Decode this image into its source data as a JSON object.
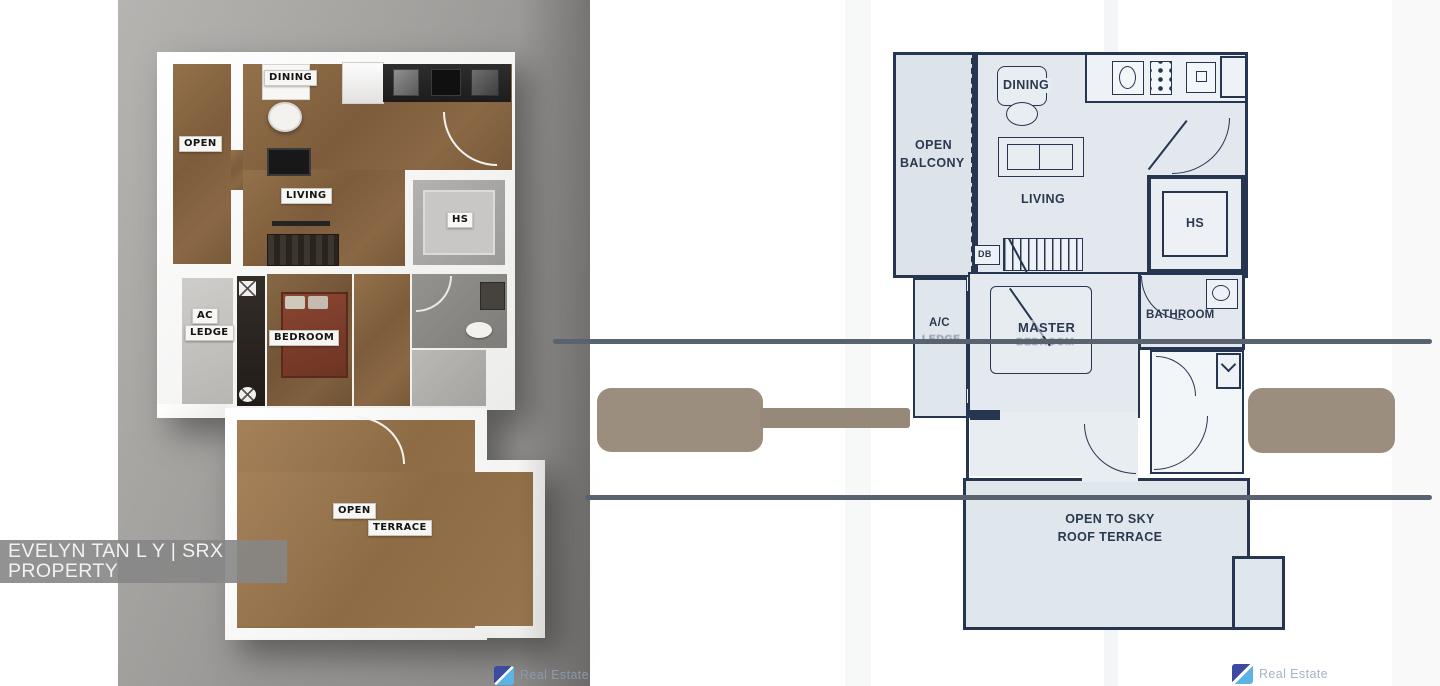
{
  "watermark": {
    "text": "EVELYN TAN L Y | SRX PROPERTY"
  },
  "brand": {
    "name": "Real Estate"
  },
  "left_plan": {
    "labels": {
      "open": "OPEN",
      "dining": "DINING",
      "living": "LIVING",
      "hs": "HS",
      "ac_line1": "AC",
      "ac_line2": "LEDGE",
      "bedroom": "BEDROOM",
      "terrace_line1": "OPEN",
      "terrace_line2": "TERRACE"
    }
  },
  "right_plan": {
    "labels": {
      "balcony_line1": "OPEN",
      "balcony_line2": "BALCONY",
      "dining": "DINING",
      "living": "LIVING",
      "hs": "HS",
      "db": "DB",
      "ac": "A/C",
      "ac_sub": "LEDGE",
      "master": "MASTER",
      "master_sub": "BEDROOM",
      "bathroom": "BATHROOM",
      "terrace_line1": "OPEN TO SKY",
      "terrace_line2": "ROOF TERRACE"
    }
  },
  "colors": {
    "blueprint_ink": "#263650",
    "blueprint_fill": "#dfe6ec",
    "floor_brown": "#8a6845",
    "bed_maroon": "#7d3c2a",
    "photo_gray": "#9a9895",
    "redaction_taupe": "#9c8e7e",
    "divider_gray": "#59636f",
    "watermark_bar_gray": "#868686",
    "logo_indigo": "#3c4aa0",
    "logo_sky": "#5ab4e4"
  }
}
